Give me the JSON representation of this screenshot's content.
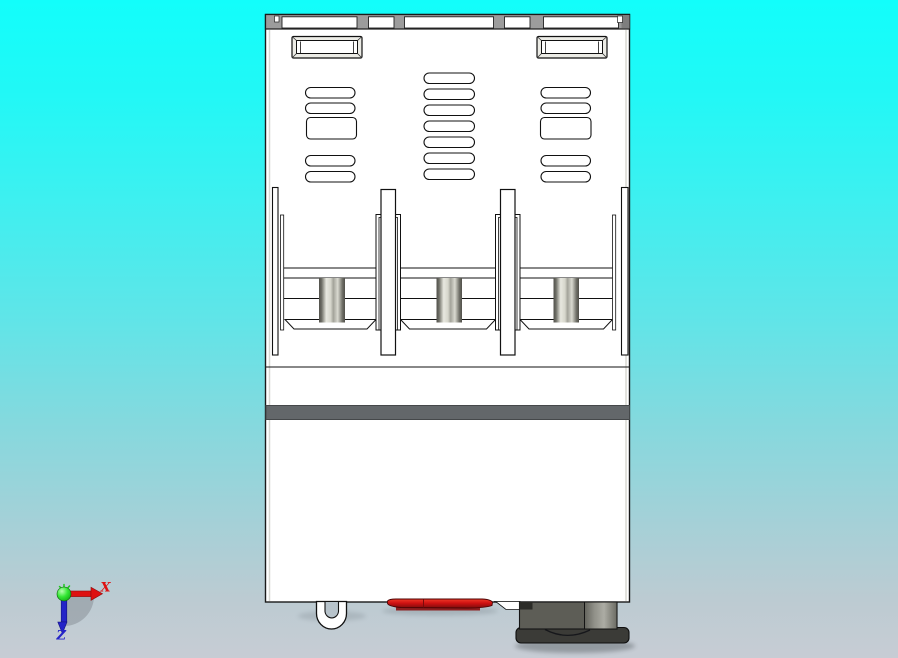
{
  "viewport": {
    "background_top": "#12FEFB",
    "background_bottom": "#C7CCD4"
  },
  "axis_triad": {
    "x_label": "X",
    "z_label": "Z"
  },
  "colors": {
    "body": "#FFFFFF",
    "outline": "#1A1A1A",
    "top_rail": "#9C9C9C",
    "top_rail_shade": "#7E7E7E",
    "stripe": "#63676A",
    "red_part": "#D01212",
    "red_part_dark": "#8A0E0E",
    "connector_body": "#5D5D56",
    "connector_cylinder": "#A8A8A0",
    "connector_flange": "#3B3B37",
    "connector_tab": "#2C2C28",
    "rod_light": "#E8E8DF",
    "rod_dark": "#51504A",
    "hook_inner": "#B7C3CB",
    "axis_x": "#DE1111",
    "axis_y": "#1DC61D",
    "axis_z": "#2424C8",
    "shadow_disc": "#7F868C"
  }
}
